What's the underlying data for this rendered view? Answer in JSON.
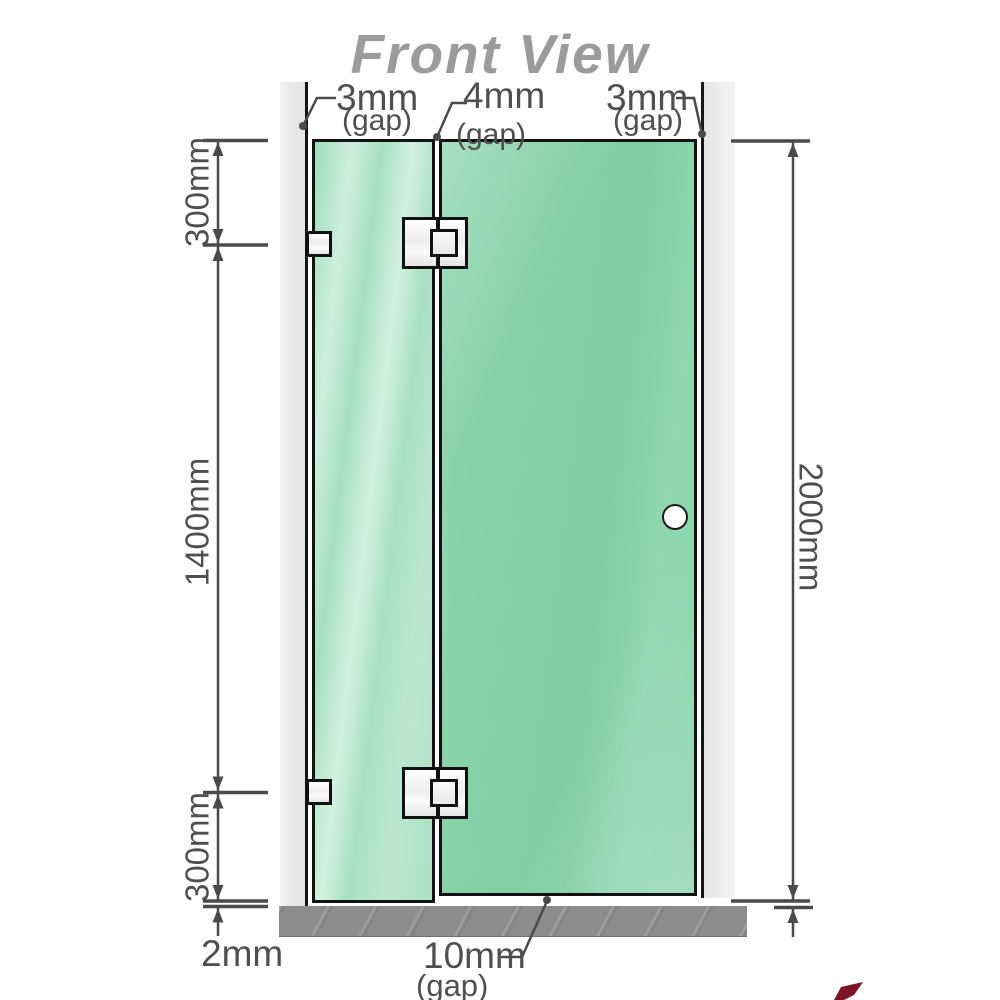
{
  "title": "Front View",
  "diagram": {
    "kind": "shower-screen front elevation",
    "top_gap_labels": [
      {
        "value": "3mm",
        "qualifier": "(gap)"
      },
      {
        "value": "4mm",
        "qualifier": "(gap)"
      },
      {
        "value": "3mm",
        "qualifier": "(gap)"
      }
    ],
    "left_dimensions": {
      "top": "300mm",
      "middle": "1400mm",
      "bottom": "300mm",
      "floor_gap": "2mm"
    },
    "right_dimension": {
      "total_height": "2000mm"
    },
    "bottom_gap": {
      "value": "10mm",
      "qualifier": "(gap)"
    }
  },
  "colors": {
    "glass_fixed_panel": "#a9dfc2",
    "glass_door_panel": "#85d0a6",
    "wall": "#ececec",
    "floor": "#8c8c8c",
    "dimension_lines": "#4a4a4a",
    "dimension_text": "#4f4f4f",
    "title_text": "#9b9b9b",
    "hardware": "#f2f2f2",
    "outline": "#121212",
    "accent_red": "#7d1326"
  }
}
